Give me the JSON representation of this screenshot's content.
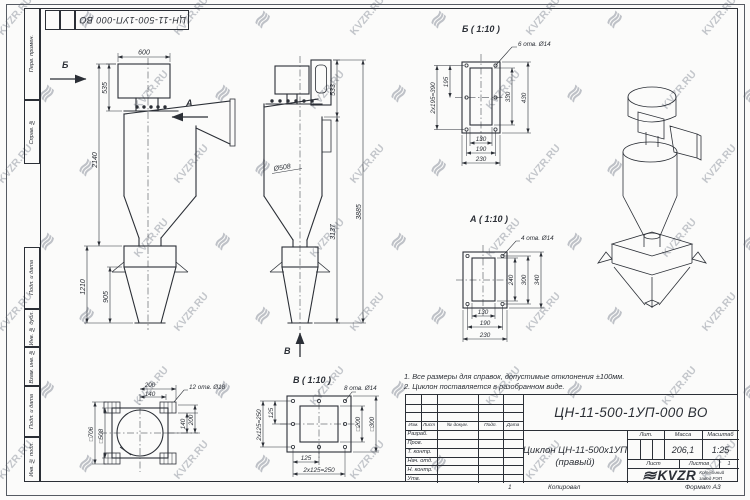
{
  "watermark": {
    "text": "KVZR.RU",
    "glyph": "≋"
  },
  "stamp_top": {
    "doc_number": "ЦН-11-500-1УП-000 ВО"
  },
  "side_panel": {
    "perv": "Перв. примен.",
    "sprav": "Справ. №",
    "podp1": "Подп. и дата",
    "inv_dubl": "Инв. № дубл.",
    "vzam": "Взам. инв. №",
    "podp2": "Подп. и дата",
    "inv_podl": "Инв. № подл."
  },
  "notes": {
    "line1": "1. Все размеры для справок, допустимые отклонения ±100мм.",
    "line2": "2. Циклон поставляется в разобранном виде."
  },
  "views": {
    "side": {
      "dim_600": "600",
      "dim_535": "535",
      "dim_2140": "2140",
      "dim_1210": "1210",
      "dim_905": "905",
      "arrow_b": "Б",
      "arrow_a": "А"
    },
    "front": {
      "dim_533": "533",
      "dim_3885": "3885",
      "dim_3137": "3137",
      "dim_d508": "Ø508",
      "arrow_v": "В"
    },
    "detail_b": {
      "title": "Б ( 1:10 )",
      "callout": "6 отв. Ø14",
      "dim_390": "2х195=390",
      "dim_195": "195",
      "dim_330": "330",
      "dim_430": "430",
      "dim_130": "130",
      "dim_190": "190",
      "dim_230": "230"
    },
    "detail_a": {
      "title": "А ( 1:10 )",
      "callout": "4 отв. Ø14",
      "dim_240": "240",
      "dim_300": "300",
      "dim_340": "340",
      "dim_130": "130",
      "dim_190": "190",
      "dim_230": "230"
    },
    "detail_v": {
      "title": "В ( 1:10 )",
      "callout": "8 отв. Ø14",
      "dim_125_l": "125",
      "dim_250_l": "2х125=250",
      "dim_200": "□200",
      "dim_300": "□300",
      "dim_125_b": "125",
      "dim_250_b": "2х125=250"
    },
    "top": {
      "callout": "12 отв. Ø18",
      "dim_200_t": "200",
      "dim_140_t": "140",
      "dim_140_r": "140",
      "dim_200_r": "200",
      "dim_706": "□706",
      "dim_508": "□508"
    }
  },
  "title_block": {
    "doc_number": "ЦН-11-500-1УП-000 ВО",
    "name_line1": "Циклон ЦН-11-500х1УП",
    "name_line2": "(правый)",
    "col_izm": "Изм.",
    "col_list": "Лист",
    "col_dokum": "№ докум.",
    "col_podp": "Подп.",
    "col_data": "Дата",
    "row_razrab": "Разраб.",
    "row_prov": "Пров.",
    "row_tkontr": "Т. контр.",
    "row_nachotd": "Нач. отд.",
    "row_nkontr": "Н. контр.",
    "row_utv": "Утв.",
    "lit_label": "Лит.",
    "mass_label": "Масса",
    "scale_label": "Масштаб",
    "mass_value": "206,1",
    "scale_value": "1:25",
    "sheet_label": "Лист",
    "sheets_label": "Листов",
    "sheets_value": "1",
    "logo_glyph": "≋",
    "logo_text": "KVZR",
    "company_line1": "Котельный",
    "company_line2": "завод РЭП",
    "footer_num": "1",
    "footer_copied": "Копировал",
    "footer_format": "Формат А3"
  }
}
